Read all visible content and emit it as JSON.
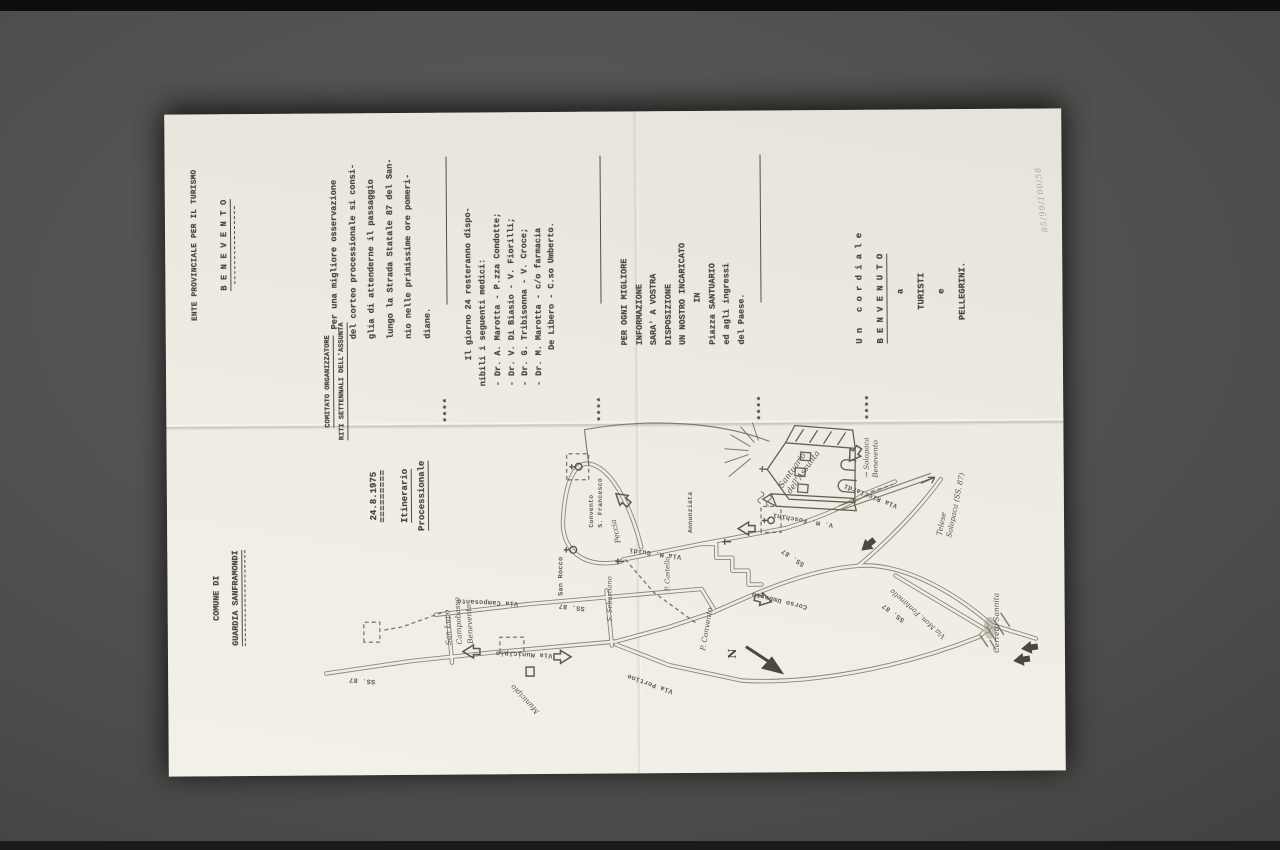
{
  "scene": {
    "background_color": "#4e4e4c",
    "paper_color": "#efede5",
    "description": "Photograph of a folded typewritten leaflet lying rotated 90 degrees on a dark grey surface"
  },
  "doc": {
    "header_left": {
      "line1": "COMUNE DI",
      "line2": "GUARDIA SANFRAMONDI"
    },
    "header_center": {
      "line1": "COMITATO ORGANIZZATORE",
      "line2": "RITI SETTENNALI DELL'ASSUNTA"
    },
    "header_right": {
      "line1": "ENTE PROVINCIALE PER IL TURISMO",
      "line2": "B E N E V E N T O"
    },
    "date_block": {
      "date": "24.8.1975",
      "rule": "=========",
      "title1": "Itinerario",
      "title2": "Processionale"
    },
    "advice": "Per una migliore osservazione\ndel corteo processionale si consi-\nglia di attenderne il passaggio\nlungo la Strada Statale 87 del San-\nnio nelle primissime ore pomeri-\ndiane.",
    "sep": "****",
    "doctors_intro": "Il giorno 24 resteranno dispo-\nnibili i seguenti medici:",
    "doctors": [
      "- Dr. A. Marotta - P.zza Condotte;",
      "- Dr. V. Di Biasio - V. Fiorilli;",
      "- Dr. G. Tribisonna - V. Croce;",
      "- Dr. M. Marotta - c/o farmacia",
      "De Libero - C.so Umberto."
    ],
    "info": [
      "PER OGNI MIGLIORE",
      "INFORMAZIONE",
      "SARA' A VOSTRA",
      "DISPOSIZIONE",
      "UN NOSTRO INCARICATO",
      "IN",
      "Piazza SANTUARIO",
      "ed agli ingressi",
      "del Paese."
    ],
    "welcome": [
      "U n   c o r d i a l e",
      "B E N V E N U T O",
      "a",
      "TURISTI",
      "e",
      "PELLEGRINI."
    ],
    "pencil_note": "85/99/100/58"
  },
  "map": {
    "labels": [
      {
        "id": "ss87-1",
        "text": "SS. 87"
      },
      {
        "id": "destination-sign",
        "text": "San Lupo\nCampobasso\nBenevento"
      },
      {
        "id": "via-municipio",
        "text": "Via Municipio"
      },
      {
        "id": "via-camposanto",
        "text": "Via Camposanto"
      },
      {
        "id": "ss87-2",
        "text": "SS. 87"
      },
      {
        "id": "municipio",
        "text": "Municipio"
      },
      {
        "id": "via-pertine",
        "text": "Via Pertine"
      },
      {
        "id": "s-sebastiano",
        "text": "S. Sebastiano"
      },
      {
        "id": "san-rocco",
        "text": "San Rocco"
      },
      {
        "id": "peccia",
        "text": "Peccia"
      },
      {
        "id": "convento-s-francesco",
        "text": "Convento\nS. Francesco"
      },
      {
        "id": "p-convento",
        "text": "P. Convento"
      },
      {
        "id": "via-m-guidi",
        "text": "Via M. Guidi"
      },
      {
        "id": "p-castello",
        "text": "P. Castello"
      },
      {
        "id": "annunziata",
        "text": "Annunziata"
      },
      {
        "id": "corso-umberto",
        "text": "Corso Umberto"
      },
      {
        "id": "ss87-3",
        "text": "SS. 87"
      },
      {
        "id": "v-m-foschini",
        "text": "V. M. Foschini"
      },
      {
        "id": "via-ricciardi",
        "text": "Via Ricciardi"
      },
      {
        "id": "santuario",
        "text": "Santuario\ndell'Assunta"
      },
      {
        "id": "solopaca-sign",
        "text": "→ Solopaca\nBenevento"
      },
      {
        "id": "telese",
        "text": "Telese\nSolopaca (SS. 87)"
      },
      {
        "id": "ss87-4",
        "text": "SS. 87"
      },
      {
        "id": "fontanella",
        "text": "Via Mon. Fontanella"
      },
      {
        "id": "cerreto-sannita",
        "text": "Cerreto Sannita"
      },
      {
        "id": "north",
        "text": "N"
      }
    ]
  }
}
